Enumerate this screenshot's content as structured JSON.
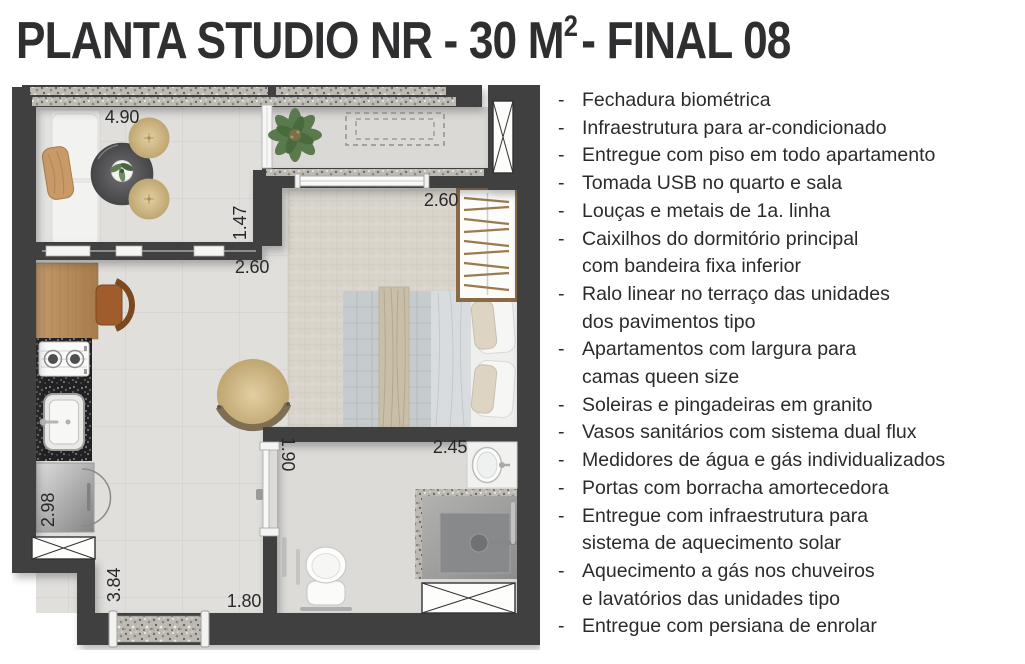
{
  "title": {
    "part1": "PLANTA STUDIO NR - 30 M",
    "sup": "2",
    "part2": "- FINAL 08"
  },
  "features": {
    "bullet": "-",
    "items": [
      "Fechadura biométrica",
      "Infraestrutura para ar-condicionado",
      "Entregue com piso em todo apartamento",
      "Tomada USB no quarto e sala",
      "Louças e metais de 1a. linha",
      "Caixilhos do dormitório principal\ncom bandeira fixa inferior",
      "Ralo linear no terraço das unidades\ndos pavimentos tipo",
      "Apartamentos com largura para\ncamas queen size",
      "Soleiras e pingadeiras em granito",
      "Vasos sanitários com sistema dual flux",
      "Medidores de água e gás individualizados",
      "Portas com borracha amortecedora",
      "Entregue com infraestrutura para\nsistema de aquecimento solar",
      "Aquecimento a gás nos chuveiros\ne lavatórios das unidades tipo",
      "Entregue com persiana de enrolar"
    ]
  },
  "plan": {
    "dimensions": [
      {
        "label": "4.90",
        "x": 110,
        "y": 38,
        "rotate": 0
      },
      {
        "label": "1.47",
        "x": 234,
        "y": 138,
        "rotate": -90
      },
      {
        "label": "2.60",
        "x": 240,
        "y": 188,
        "rotate": 0
      },
      {
        "label": "2.60",
        "x": 429,
        "y": 121,
        "rotate": 0
      },
      {
        "label": "2.45",
        "x": 438,
        "y": 368,
        "rotate": 0
      },
      {
        "label": "1.90",
        "x": 270,
        "y": 369,
        "rotate": 90
      },
      {
        "label": "2.98",
        "x": 42,
        "y": 425,
        "rotate": -90
      },
      {
        "label": "3.84",
        "x": 108,
        "y": 500,
        "rotate": -90
      },
      {
        "label": "1.80",
        "x": 232,
        "y": 522,
        "rotate": 0
      }
    ],
    "colors": {
      "wall": "#3f3f41",
      "floor": "#e0dfdc",
      "granite_light": "#bdbab3",
      "granite_dark": "#212123",
      "wood": "#b08455",
      "upholstery_tan": "#c9ab77",
      "text": "#29292b"
    }
  }
}
